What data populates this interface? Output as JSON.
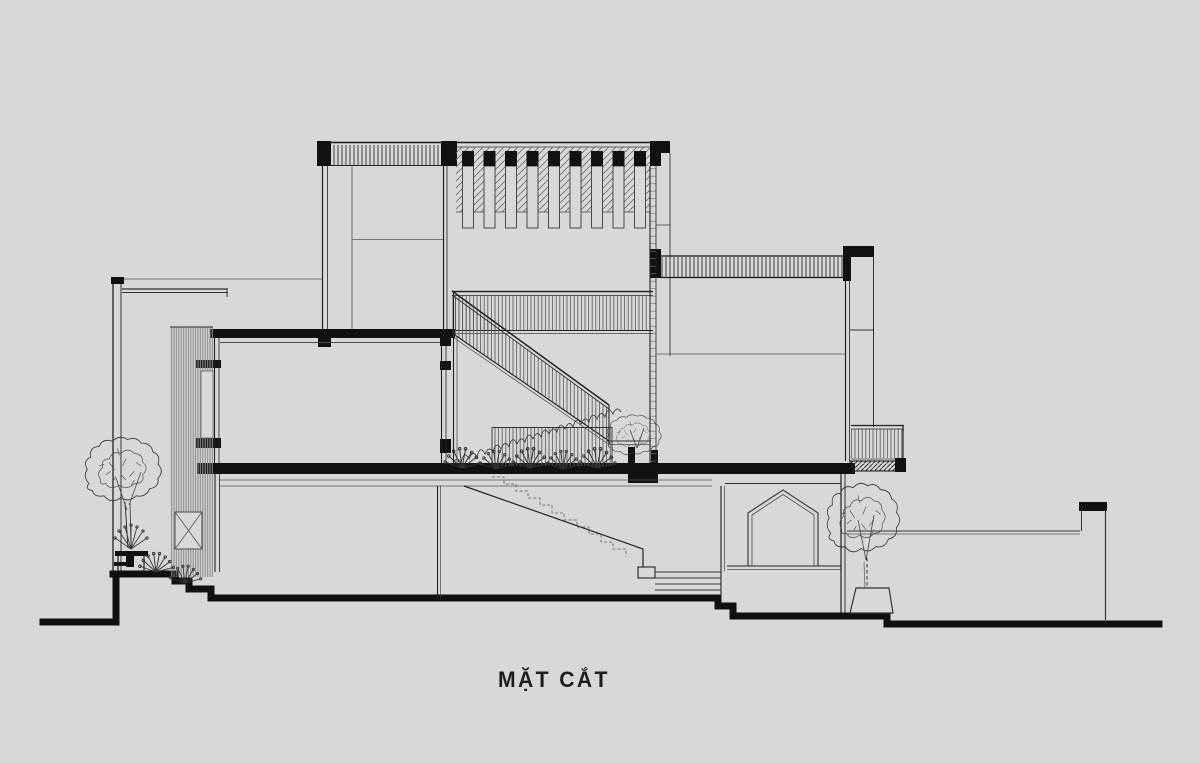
{
  "page": {
    "background": "#d8d8d8",
    "ink": "#161616",
    "line_gray": "#555555"
  },
  "title": {
    "label": "MẶT CẮT"
  },
  "drawing": {
    "kind": "architectural cross-section elevation",
    "louver_slat_count": 9,
    "tree_count": 3,
    "stair_flight_count": 2
  }
}
